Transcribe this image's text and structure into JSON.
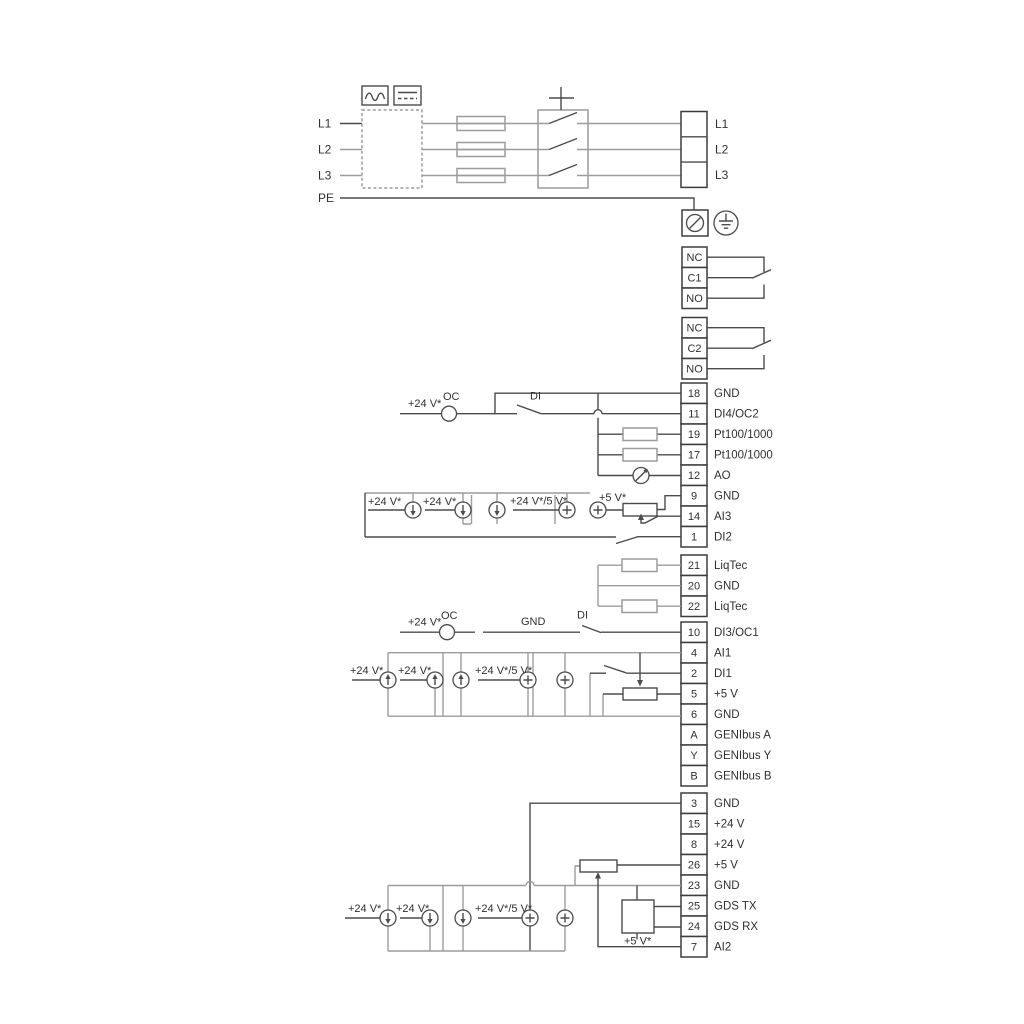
{
  "power": {
    "input_labels": [
      "L1",
      "L2",
      "L3",
      "PE"
    ],
    "output_labels": [
      "L1",
      "L2",
      "L3"
    ],
    "icons": {
      "ac_symbol": "∿",
      "dc_symbol": "⎓",
      "earth_symbol": "⏚",
      "pe_terminal": "⊘"
    }
  },
  "relays": {
    "relay1": [
      "NC",
      "C1",
      "NO"
    ],
    "relay2": [
      "NC",
      "C2",
      "NO"
    ]
  },
  "terminals": {
    "group1": [
      {
        "num": "18",
        "label": "GND"
      },
      {
        "num": "11",
        "label": "DI4/OC2"
      },
      {
        "num": "19",
        "label": "Pt100/1000"
      },
      {
        "num": "17",
        "label": "Pt100/1000"
      },
      {
        "num": "12",
        "label": "AO"
      },
      {
        "num": "9",
        "label": "GND"
      },
      {
        "num": "14",
        "label": "AI3"
      },
      {
        "num": "1",
        "label": "DI2"
      }
    ],
    "liqtec": [
      {
        "num": "21",
        "label": "LiqTec"
      },
      {
        "num": "20",
        "label": "GND"
      },
      {
        "num": "22",
        "label": "LiqTec"
      }
    ],
    "group2": [
      {
        "num": "10",
        "label": "DI3/OC1"
      },
      {
        "num": "4",
        "label": "AI1"
      },
      {
        "num": "2",
        "label": "DI1"
      },
      {
        "num": "5",
        "label": "+5 V"
      },
      {
        "num": "6",
        "label": "GND"
      },
      {
        "num": "A",
        "label": "GENIbus A"
      },
      {
        "num": "Y",
        "label": "GENIbus Y"
      },
      {
        "num": "B",
        "label": "GENIbus B"
      }
    ],
    "group3": [
      {
        "num": "3",
        "label": "GND"
      },
      {
        "num": "15",
        "label": "+24 V"
      },
      {
        "num": "8",
        "label": "+24 V"
      },
      {
        "num": "26",
        "label": "+5 V"
      },
      {
        "num": "23",
        "label": "GND"
      },
      {
        "num": "25",
        "label": "GDS TX"
      },
      {
        "num": "24",
        "label": "GDS RX"
      },
      {
        "num": "7",
        "label": "AI2"
      }
    ]
  },
  "wiring_labels": {
    "v24": "+24 V*",
    "v24_5": "+24 V*/5 V*",
    "v5": "+5 V*",
    "oc": "OC",
    "di": "DI",
    "gnd": "GND"
  },
  "colors": {
    "wire_dark": "#4b4b4b",
    "wire_gray": "#9c9c9c",
    "terminal_border": "#3d3d3d",
    "text": "#303030",
    "background": "#ffffff"
  }
}
